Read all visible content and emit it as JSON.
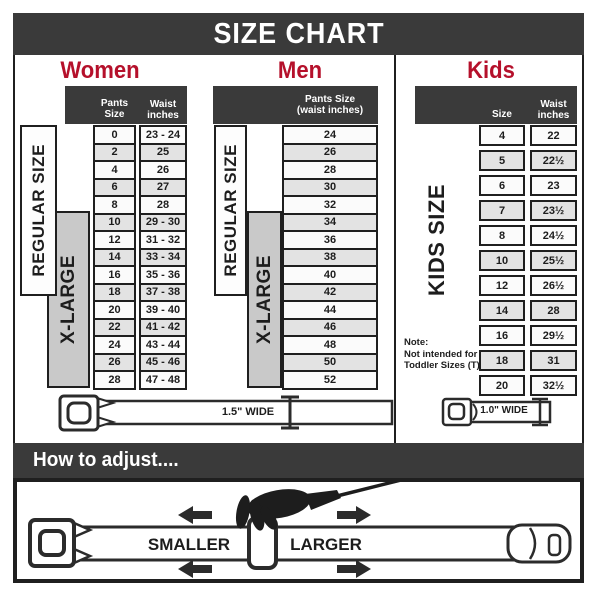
{
  "title": "SIZE CHART",
  "colors": {
    "accent_red": "#b5102b",
    "bar_dark": "#3a3a3a",
    "row_gray": "#e3e3e3",
    "xlarge_gray": "#c9c9c9",
    "line_art": "#2b2b2b"
  },
  "sections": {
    "women": {
      "heading": "Women",
      "pants_header": "Pants Size",
      "waist_header": "Waist\ninches",
      "regular_label": "REGULAR SIZE",
      "xlarge_label": "X-LARGE",
      "rows": [
        {
          "size": "0",
          "waist": "23 - 24"
        },
        {
          "size": "2",
          "waist": "25"
        },
        {
          "size": "4",
          "waist": "26"
        },
        {
          "size": "6",
          "waist": "27"
        },
        {
          "size": "8",
          "waist": "28"
        },
        {
          "size": "10",
          "waist": "29 - 30"
        },
        {
          "size": "12",
          "waist": "31 - 32"
        },
        {
          "size": "14",
          "waist": "33 - 34"
        },
        {
          "size": "16",
          "waist": "35 - 36"
        },
        {
          "size": "18",
          "waist": "37 - 38"
        },
        {
          "size": "20",
          "waist": "39 - 40"
        },
        {
          "size": "22",
          "waist": "41 - 42"
        },
        {
          "size": "24",
          "waist": "43 - 44"
        },
        {
          "size": "26",
          "waist": "45 - 46"
        },
        {
          "size": "28",
          "waist": "47 - 48"
        }
      ]
    },
    "men": {
      "heading": "Men",
      "header_line1": "Pants Size",
      "header_line2": "(waist inches)",
      "regular_label": "REGULAR SIZE",
      "xlarge_label": "X-LARGE",
      "rows": [
        {
          "size": "24"
        },
        {
          "size": "26"
        },
        {
          "size": "28"
        },
        {
          "size": "30"
        },
        {
          "size": "32"
        },
        {
          "size": "34"
        },
        {
          "size": "36"
        },
        {
          "size": "38"
        },
        {
          "size": "40"
        },
        {
          "size": "42"
        },
        {
          "size": "44"
        },
        {
          "size": "46"
        },
        {
          "size": "48"
        },
        {
          "size": "50"
        },
        {
          "size": "52"
        }
      ]
    },
    "kids": {
      "heading": "Kids",
      "size_header": "Size",
      "waist_header": "Waist\ninches",
      "side_label": "KIDS SIZE",
      "note": "Note:\nNot intended for\nToddler Sizes (T)",
      "rows": [
        {
          "size": "4",
          "waist": "22"
        },
        {
          "size": "5",
          "waist": "22½"
        },
        {
          "size": "6",
          "waist": "23"
        },
        {
          "size": "7",
          "waist": "23½"
        },
        {
          "size": "8",
          "waist": "24½"
        },
        {
          "size": "10",
          "waist": "25½"
        },
        {
          "size": "12",
          "waist": "26½"
        },
        {
          "size": "14",
          "waist": "28"
        },
        {
          "size": "16",
          "waist": "29½"
        },
        {
          "size": "18",
          "waist": "31"
        },
        {
          "size": "20",
          "waist": "32½"
        }
      ]
    }
  },
  "belts": {
    "adult_width": "1.5\" WIDE",
    "kids_width": "1.0\" WIDE"
  },
  "adjust": {
    "heading": "How to adjust....",
    "smaller": "SMALLER",
    "larger": "LARGER"
  }
}
